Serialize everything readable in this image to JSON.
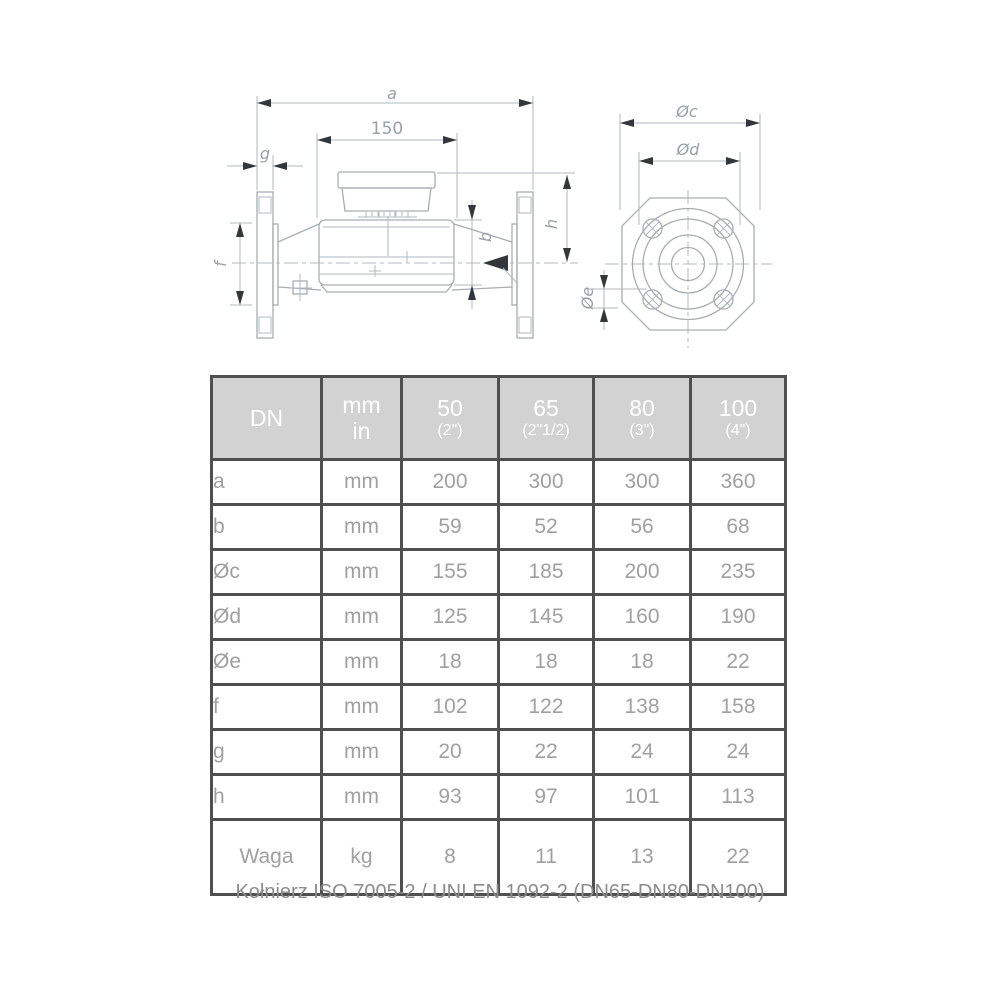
{
  "drawing": {
    "side_view": {
      "dim_a": "a",
      "dim_150": "150",
      "dim_g": "g",
      "dim_f": "f",
      "dim_b": "b",
      "dim_h": "h"
    },
    "front_view": {
      "dim_c": "Øc",
      "dim_d": "Ød",
      "dim_e": "Øe"
    }
  },
  "table": {
    "header": {
      "dn": "DN",
      "unit_line1": "mm",
      "unit_line2": "in",
      "columns": [
        {
          "size": "50",
          "inches": "(2\")"
        },
        {
          "size": "65",
          "inches": "(2\"1/2)"
        },
        {
          "size": "80",
          "inches": "(3\")"
        },
        {
          "size": "100",
          "inches": "(4\")"
        }
      ]
    },
    "rows": [
      {
        "label": "a",
        "unit": "mm",
        "values": [
          "200",
          "300",
          "300",
          "360"
        ]
      },
      {
        "label": "b",
        "unit": "mm",
        "values": [
          "59",
          "52",
          "56",
          "68"
        ]
      },
      {
        "label": "Øc",
        "unit": "mm",
        "values": [
          "155",
          "185",
          "200",
          "235"
        ]
      },
      {
        "label": "Ød",
        "unit": "mm",
        "values": [
          "125",
          "145",
          "160",
          "190"
        ]
      },
      {
        "label": "Øe",
        "unit": "mm",
        "values": [
          "18",
          "18",
          "18",
          "22"
        ]
      },
      {
        "label": "f",
        "unit": "mm",
        "values": [
          "102",
          "122",
          "138",
          "158"
        ]
      },
      {
        "label": "g",
        "unit": "mm",
        "values": [
          "20",
          "22",
          "24",
          "24"
        ]
      },
      {
        "label": "h",
        "unit": "mm",
        "values": [
          "93",
          "97",
          "101",
          "113"
        ]
      },
      {
        "label": "Waga",
        "unit": "kg",
        "values": [
          "8",
          "11",
          "13",
          "22"
        ]
      }
    ]
  },
  "footer": {
    "note": "Kołnierz ISO 7005-2 / UNI EN 1092-2 (DN65-DN80-DN100)"
  },
  "colors": {
    "header_bg": "#d2d2d2",
    "header_text": "#ffffff",
    "table_border": "#4f4f4f",
    "cell_text": "#a0a0a0",
    "drawing_line": "#a8adb2",
    "arrowhead": "#34373a",
    "dim_text": "#9aa0a5"
  }
}
